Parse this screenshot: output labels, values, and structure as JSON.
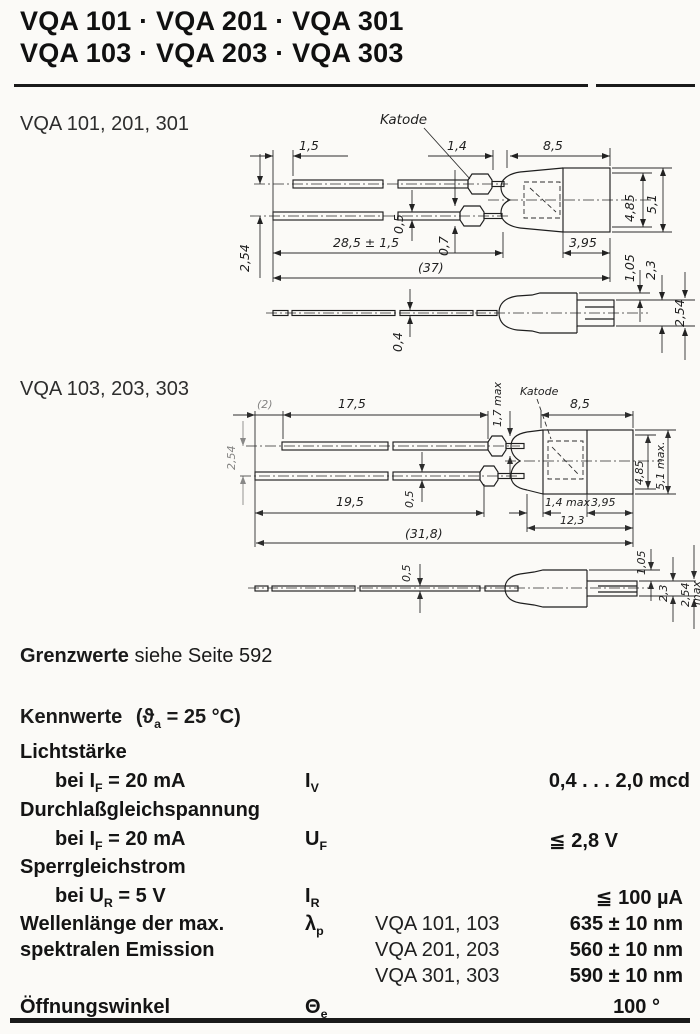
{
  "title": {
    "line1": "VQA 101 · VQA 201 · VQA 301",
    "line2": "VQA 103 · VQA 203 · VQA 303"
  },
  "drawing1": {
    "label": "VQA 101, 201, 301",
    "katode": "Katode",
    "dims": {
      "lead_offset": "1,5",
      "lead_pitch": "2,54",
      "crimp_len": "1,4",
      "body_len": "8,5",
      "lead_thickness": "0,5",
      "crimp_thickness": "0,7",
      "lead_len": "28,5 ± 1,5",
      "overall_len": "(37)",
      "cap_len": "3,95",
      "body_dia": "4,85",
      "body_dia_max": "5,1",
      "side_lead_thickness": "0,4",
      "nub_offset": "1,05",
      "nub_height": "2,3",
      "nub_max": "2,54"
    }
  },
  "drawing2": {
    "label": "VQA 103, 203, 303",
    "katode": "Katode",
    "dims": {
      "lead_offset": "(2)",
      "top_lead_len": "17,5",
      "crimp_thickness": "1,7 max",
      "body_len": "8,5",
      "lead_pitch": "2,54",
      "lead_thickness": "0,5",
      "bottom_lead_len": "19,5",
      "dome_len": "1,4 max",
      "cap_len": "3,95",
      "body_total": "12,3",
      "overall_len": "(31,8)",
      "body_dia": "4,85",
      "body_dia_max": "5,1 max.",
      "side_lead_thickness": "0,5",
      "nub_offset": "1,05",
      "nub_height": "2,3",
      "nub_max": "2,54",
      "nub_max_suffix": "max"
    }
  },
  "grenzwerte": {
    "heading": "Grenzwerte",
    "text": "siehe Seite 592"
  },
  "kennwerte": {
    "heading": "Kennwerte",
    "cond_pre": "(ϑ",
    "cond_sub": "a",
    "cond_post": " = 25 °C)"
  },
  "table": {
    "lichtstaerke": {
      "heading": "Lichtstärke",
      "cond_pre": "bei I",
      "cond_sub": "F",
      "cond_post": " = 20 mA",
      "sym": "I",
      "sym_sub": "V",
      "value": "0,4 . . . 2,0 mcd"
    },
    "durchlass": {
      "heading": "Durchlaßgleichspannung",
      "cond_pre": "bei I",
      "cond_sub": "F",
      "cond_post": " = 20 mA",
      "sym": "U",
      "sym_sub": "F",
      "value": "≦ 2,8 V"
    },
    "sperr": {
      "heading": "Sperrgleichstrom",
      "cond_pre": "bei U",
      "cond_sub": "R",
      "cond_post": " = 5 V",
      "sym": "I",
      "sym_sub": "R",
      "value": "≦ 100 µA"
    },
    "wellenlaenge": {
      "label_line1": "Wellenlänge der max.",
      "label_line2": "spektralen Emission",
      "sym": "λ",
      "sym_sub": "p",
      "entries": [
        {
          "models": "VQA 101, 103",
          "value": "635 ± 10 nm"
        },
        {
          "models": "VQA 201, 203",
          "value": "560 ± 10 nm"
        },
        {
          "models": "VQA 301, 303",
          "value": "590 ± 10 nm"
        }
      ]
    },
    "oeffnungswinkel": {
      "label": "Öffnungswinkel",
      "sym": "Θ",
      "sym_sub": "e",
      "value": "100 °"
    }
  }
}
